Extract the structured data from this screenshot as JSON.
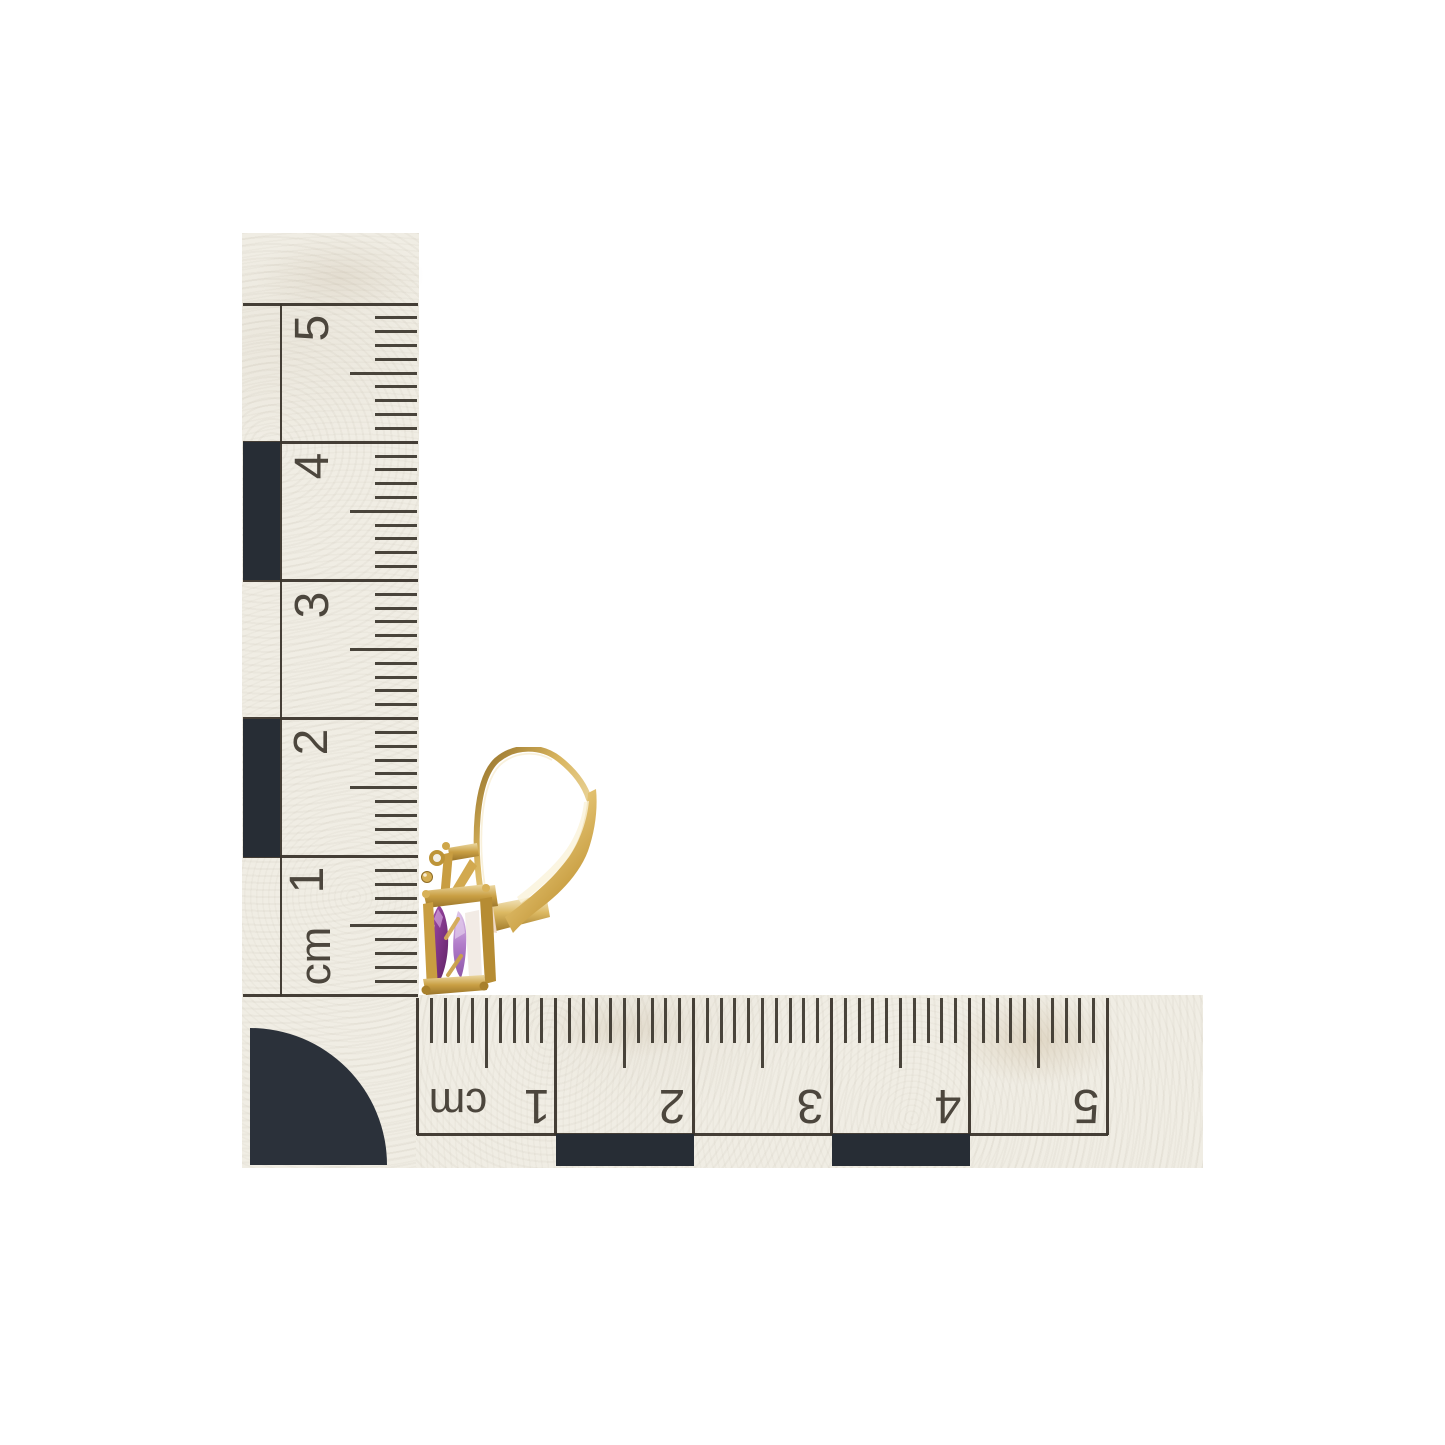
{
  "scene": {
    "description": "Yellow-gold leverback earring with a purple marquise gemstone photographed beside an L-shaped centimetre photo scale on a white background",
    "background_color": "#ffffff",
    "paper_color": "#f0ede4",
    "ink_color": "#3b352c",
    "checker_color": "#272d35"
  },
  "vertical_scale": {
    "unit": "cm",
    "labels": [
      "5",
      "4",
      "3",
      "2",
      "1",
      "cm"
    ]
  },
  "horizontal_scale": {
    "unit": "cm",
    "labels": [
      "cm",
      "1",
      "2",
      "3",
      "4",
      "5"
    ]
  },
  "earring": {
    "metal_color": "#c99f43",
    "metal_light": "#ecd9a4",
    "metal_highlight": "#f8f0d8",
    "metal_shadow": "#8f6c25",
    "metal_deep": "#6f541d",
    "stone_color": "#8d3e96",
    "stone_highlight": "#c79ad6",
    "stone_pale": "#ddc4e9",
    "stone_shadow": "#5e2462",
    "reflection_warm": "#eed7c3",
    "reflection_pink": "#f4e1d9"
  }
}
